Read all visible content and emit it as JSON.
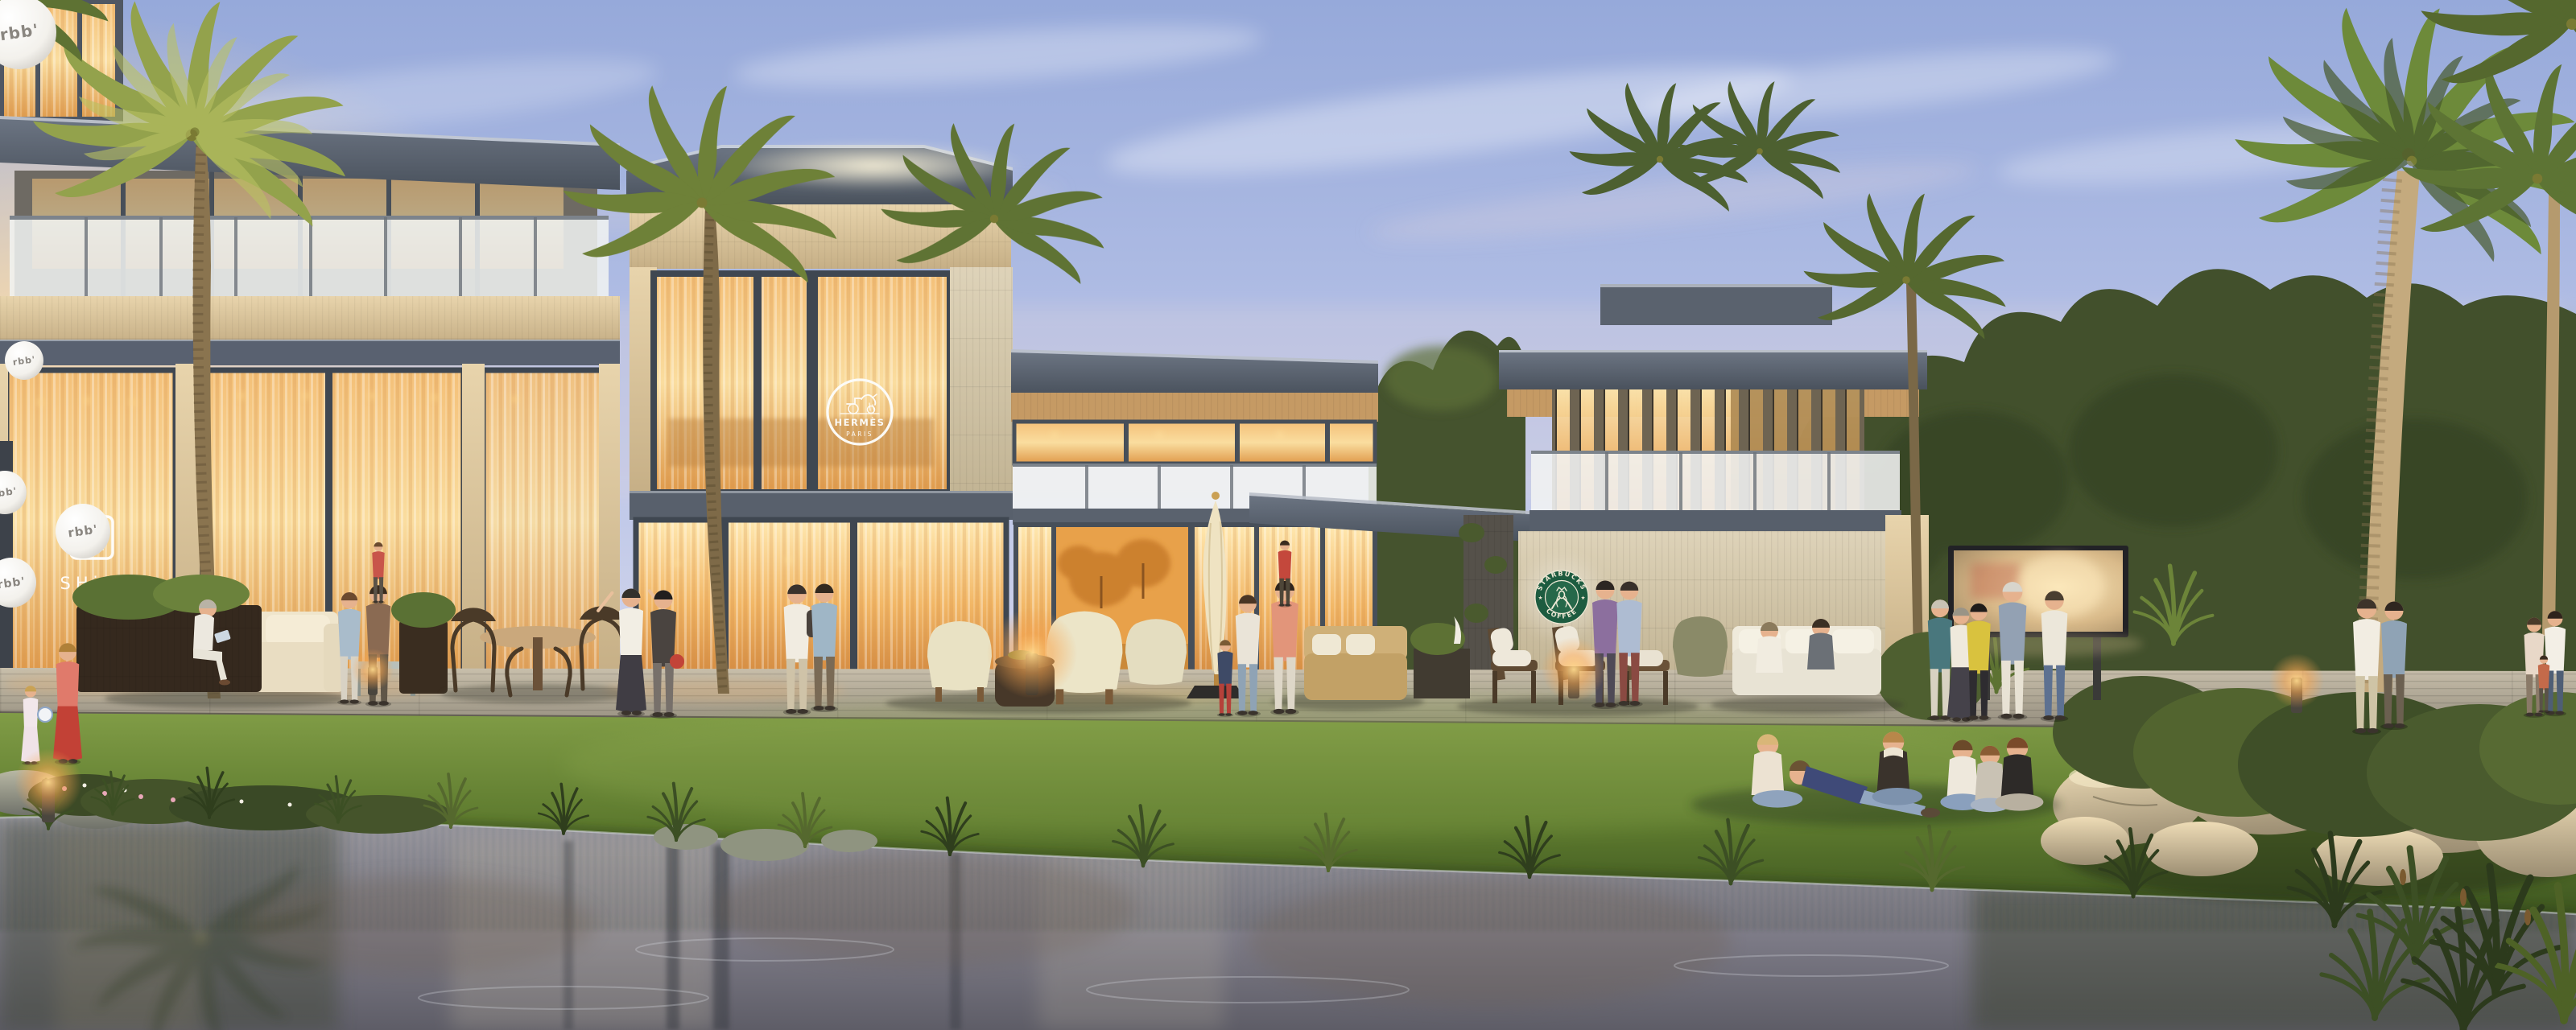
{
  "scene": {
    "type": "architectural-rendering",
    "setting": "Twilight rendering of a modern lakeside clubhouse retail promenade with palm trees, lawn, visitors and a reflecting pond"
  },
  "branding": {
    "balloon_label": "rbb'",
    "shiki_symbol": "四",
    "shiki_name": "SHiKI",
    "hermes_name": "HERMÈS",
    "hermes_city": "PARIS",
    "starbucks_word_top": "STARBUCKS",
    "starbucks_word_bottom": "COFFEE",
    "starbucks_star": "★"
  },
  "palette": {
    "sky_top": "#9db0dd",
    "sky_horizon": "#e9e2e6",
    "sunset_glow": "#ffd9a0",
    "roof_slate": "#5b636f",
    "soffit_beige": "#d9c49c",
    "stone_wall": "#d7cbb0",
    "window_glow": "#f6c277",
    "glass_frosted": "#f1f3f2",
    "palm_green": "#6e8138",
    "tree_green": "#42502c",
    "lawn_green": "#6d8a3c",
    "pond_grey": "#8e8e9a",
    "starbucks_green": "#1d5c40",
    "logo_white": "#f7f5ef",
    "balloon_text_grey": "#8a8680",
    "deck_grey": "#b3ab9b"
  }
}
